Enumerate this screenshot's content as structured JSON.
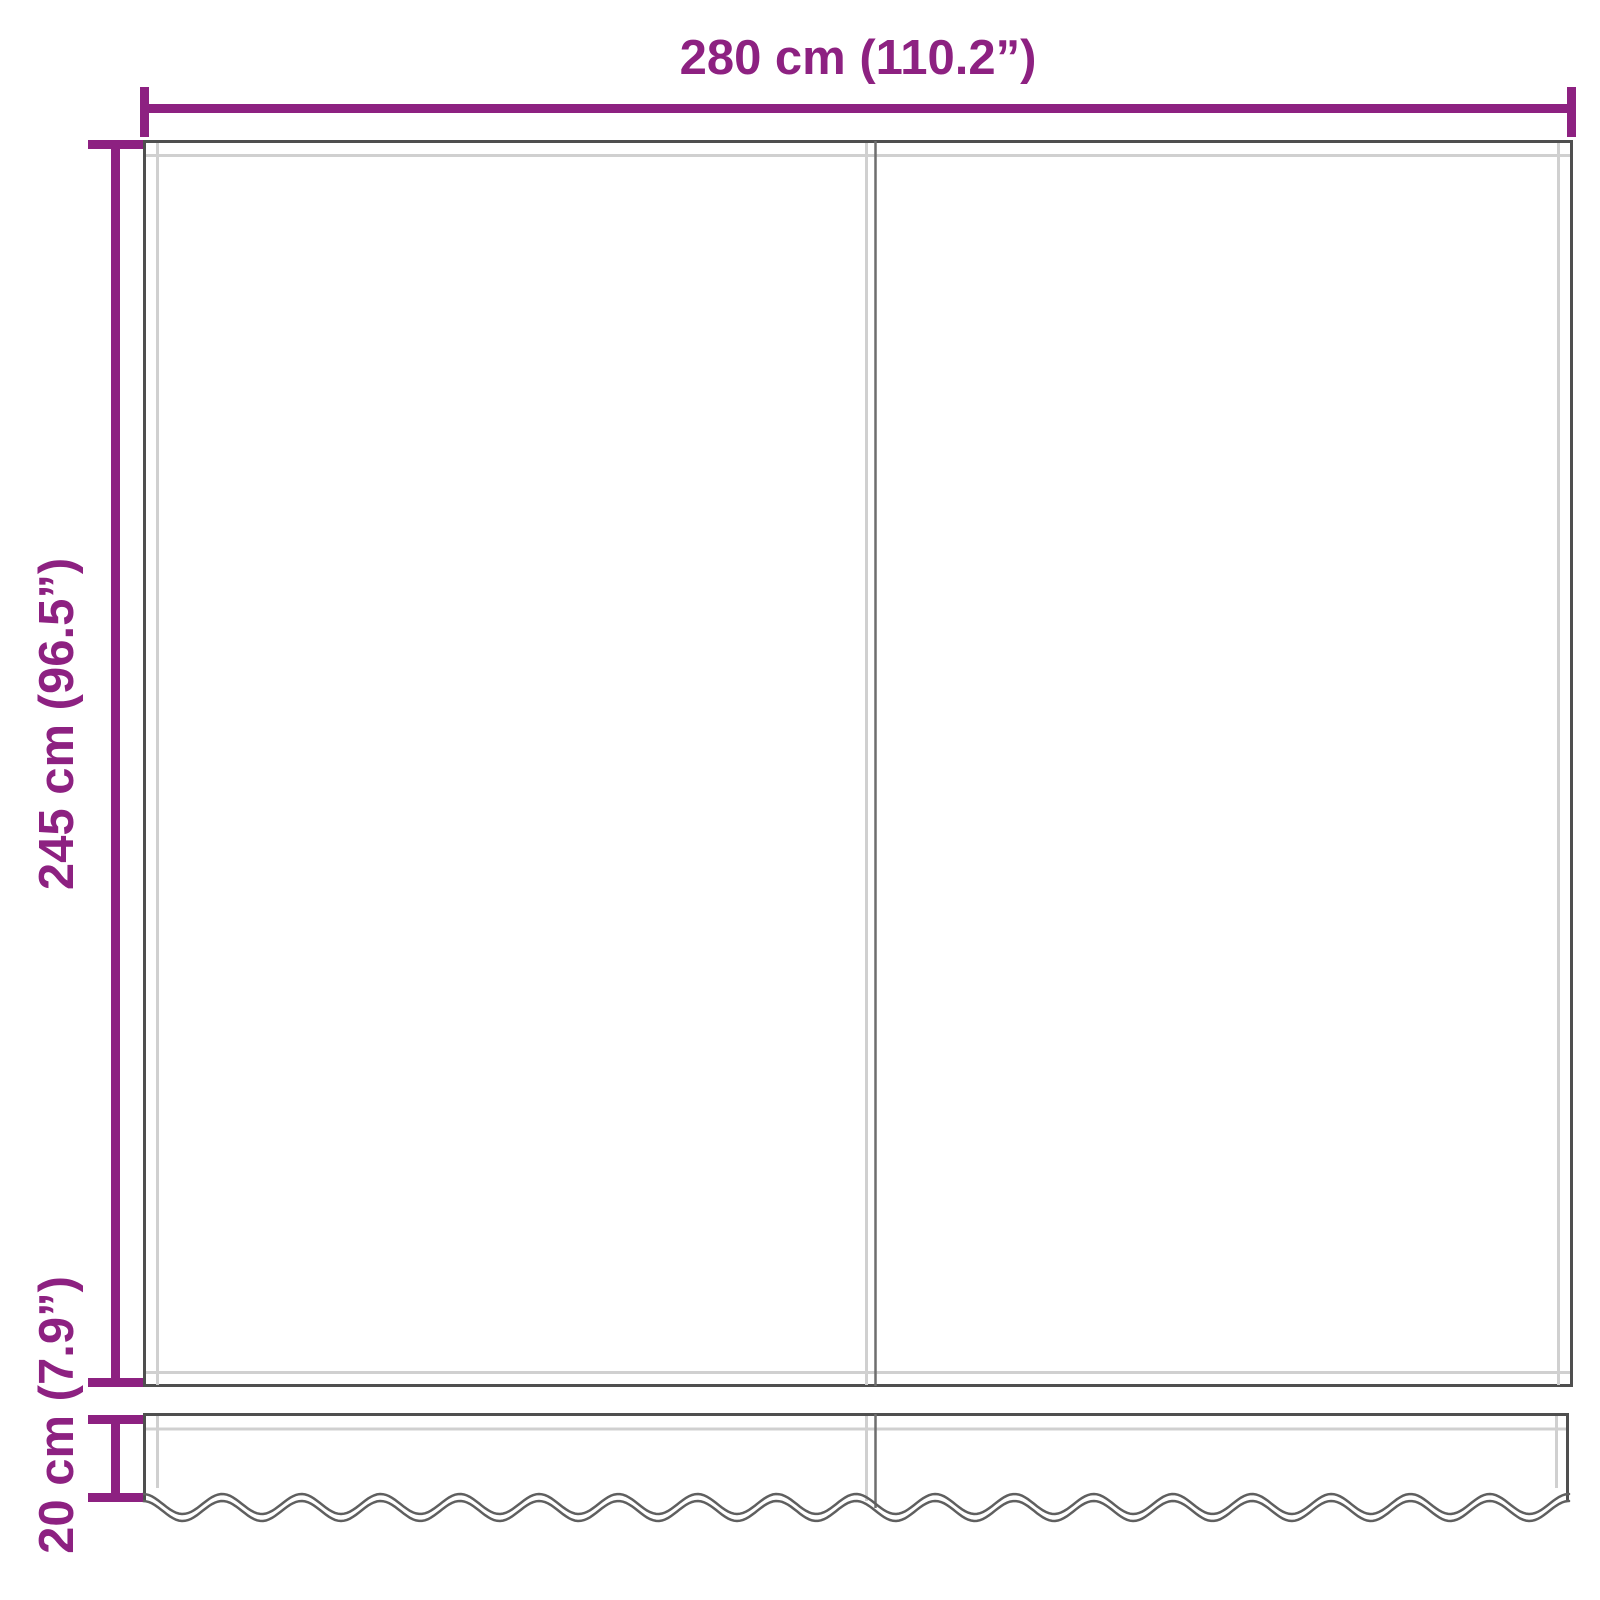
{
  "diagram": {
    "dimensions": {
      "width": {
        "label": "280 cm (110.2”)",
        "orientation": "horizontal"
      },
      "height": {
        "label": "245 cm (96.5”)",
        "orientation": "vertical"
      },
      "valance": {
        "label": "20 cm (7.9”)",
        "orientation": "vertical"
      }
    },
    "colors": {
      "dimension_accent": "#8d2181",
      "fabric_outline": "#4f4f4f",
      "hem_stitch": "#d0d0d0",
      "background": "#ffffff"
    }
  }
}
